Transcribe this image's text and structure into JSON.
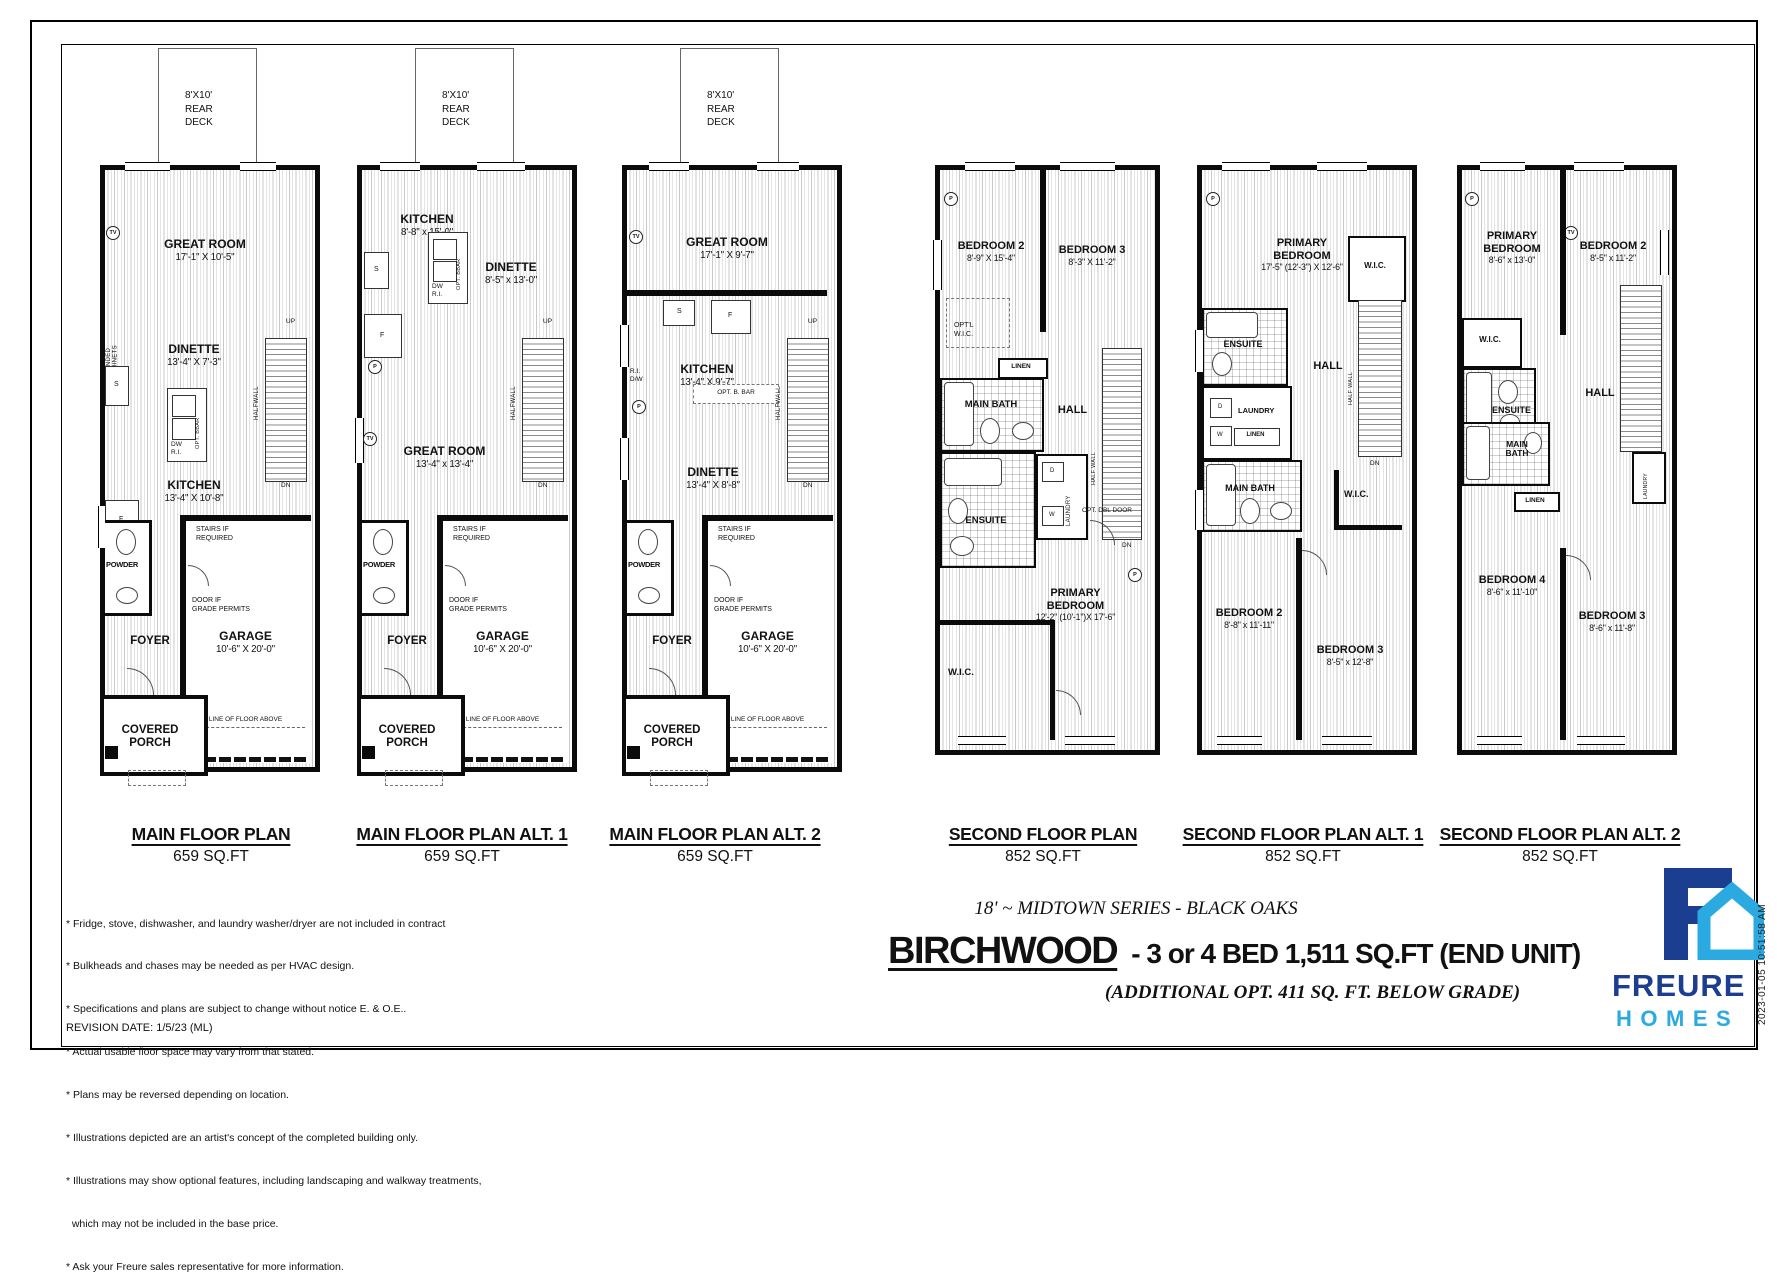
{
  "sheet": {
    "revision": "REVISION DATE: 1/5/23 (ML)",
    "timestamp": "2023-01-05 10:51:58 AM"
  },
  "footer": {
    "series": "18' ~ MIDTOWN SERIES - BLACK OAKS",
    "model_name": "BIRCHWOOD",
    "model_specs": "- 3 or 4 BED  1,511 SQ.FT (END UNIT)",
    "additional": "(ADDITIONAL  OPT. 411 SQ. FT. BELOW GRADE)",
    "disclaimers": [
      "* Fridge, stove, dishwasher, and laundry washer/dryer are not included in contract",
      "* Bulkheads and chases may be needed as per HVAC design.",
      "* Specifications and plans are subject to change without notice E. & O.E..",
      "* Actual usable floor space may vary from that stated.",
      "* Plans may be reversed depending on location.",
      "* Illustrations depicted are an artist's concept of the completed building only.",
      "* Illustrations may show optional features, including landscaping and walkway treatments,",
      "  which may not be included in the base price.",
      "* Ask your Freure sales representative for more information."
    ]
  },
  "logo": {
    "brand": "FREURE",
    "sub": "HOMES",
    "navy": "#1c3e90",
    "blue": "#2baae2"
  },
  "ann": {
    "deck": "8'X10'\nREAR\nDECK",
    "covered_porch": "COVERED\nPORCH",
    "stairs_req": "STAIRS IF\nREQUIRED",
    "door_grade": "DOOR IF\nGRADE PERMITS",
    "line_above": "LINE OF FLOOR ABOVE",
    "powder": "POWDER",
    "foyer": "FOYER",
    "up": "UP",
    "dn": "DN",
    "halfwall": "HALFWALL",
    "half_wall": "HALF WALL",
    "dw_ri": "DW\nR.I.",
    "ri_dw": "R.I.\nD/W",
    "opt_bbar": "OPT. BBAR",
    "opt_b_bar": "OPT. B. BAR",
    "opt_cabinets": "OPT'L EXTENDED\nLOWER CABINETS",
    "tv": "TV",
    "p": "P",
    "f": "F",
    "s": "S",
    "d": "D",
    "w": "W",
    "linen": "LINEN",
    "laundry": "LAUNDRY",
    "hall": "HALL",
    "ensuite": "ENSUITE",
    "main_bath": "MAIN BATH",
    "main_bath2": "MAIN\nBATH",
    "wic": "W.I.C.",
    "opt_wic": "OPT'L\nW.I.C.",
    "opt_dbl": "OPT. DBL DOOR"
  },
  "plans": {
    "p1": {
      "title": "MAIN FLOOR PLAN",
      "area": "659 SQ.FT",
      "rooms": {
        "great": {
          "n": "GREAT ROOM",
          "d": "17'-1\" X 10'-5\""
        },
        "dinette": {
          "n": "DINETTE",
          "d": "13'-4\" X 7'-3\""
        },
        "kitchen": {
          "n": "KITCHEN",
          "d": "13'-4\" X 10'-8\""
        },
        "garage": {
          "n": "GARAGE",
          "d": "10'-6\" X 20'-0\""
        }
      }
    },
    "p2": {
      "title": "MAIN FLOOR PLAN ALT. 1",
      "area": "659 SQ.FT",
      "rooms": {
        "kitchen": {
          "n": "KITCHEN",
          "d": "8'-8\" x 15'-0\""
        },
        "dinette": {
          "n": "DINETTE",
          "d": "8'-5\" x 13'-0\""
        },
        "great": {
          "n": "GREAT ROOM",
          "d": "13'-4\" x 13'-4\""
        },
        "garage": {
          "n": "GARAGE",
          "d": "10'-6\" X 20'-0\""
        }
      }
    },
    "p3": {
      "title": "MAIN FLOOR PLAN ALT. 2",
      "area": "659 SQ.FT",
      "rooms": {
        "great": {
          "n": "GREAT ROOM",
          "d": "17'-1\" X 9'-7\""
        },
        "kitchen": {
          "n": "KITCHEN",
          "d": "13'-4\" X 9'-7\""
        },
        "dinette": {
          "n": "DINETTE",
          "d": "13'-4\" X 8'-8\""
        },
        "garage": {
          "n": "GARAGE",
          "d": "10'-6\" X 20'-0\""
        }
      }
    },
    "p4": {
      "title": "SECOND FLOOR PLAN",
      "area": "852 SQ.FT",
      "rooms": {
        "bed2": {
          "n": "BEDROOM 2",
          "d": "8'-9\" X 15'-4\""
        },
        "bed3": {
          "n": "BEDROOM 3",
          "d": "8'-3\" X 11'-2\""
        },
        "primary": {
          "n": "PRIMARY\nBEDROOM",
          "d": "12'-2\"  (10'-1\")X 17'-6\""
        }
      }
    },
    "p5": {
      "title": "SECOND FLOOR PLAN ALT. 1",
      "area": "852 SQ.FT",
      "rooms": {
        "primary": {
          "n": "PRIMARY\nBEDROOM",
          "d": "17'-5\" (12'-3\") X 12'-6\""
        },
        "bed2": {
          "n": "BEDROOM 2",
          "d": "8'-8\" x 11'-11\""
        },
        "bed3": {
          "n": "BEDROOM 3",
          "d": "8'-5\" x 12'-8\""
        }
      }
    },
    "p6": {
      "title": "SECOND FLOOR PLAN ALT. 2",
      "area": "852 SQ.FT",
      "rooms": {
        "primary": {
          "n": "PRIMARY\nBEDROOM",
          "d": "8'-6\" x 13'-0\""
        },
        "bed2": {
          "n": "BEDROOM 2",
          "d": "8'-5\" x 11'-2\""
        },
        "bed4": {
          "n": "BEDROOM 4",
          "d": "8'-6\" x 11'-10\""
        },
        "bed3": {
          "n": "BEDROOM 3",
          "d": "8'-6\" x 11'-8\""
        }
      }
    }
  }
}
